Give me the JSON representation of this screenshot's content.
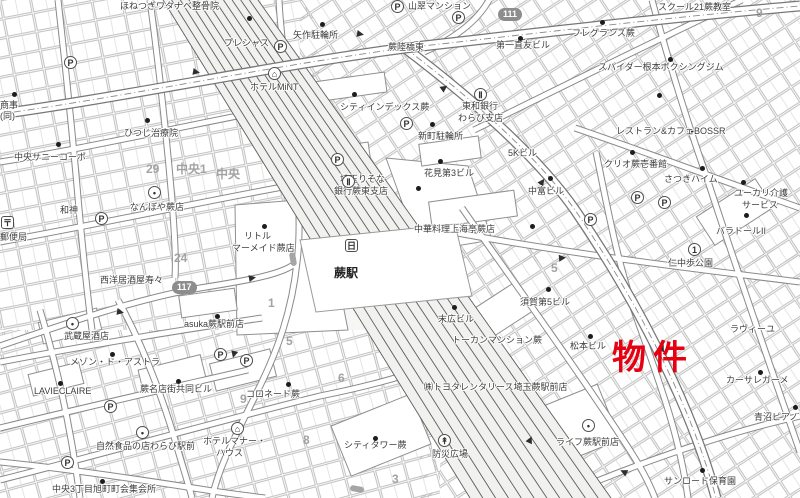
{
  "map": {
    "property_marker": {
      "text": "物件",
      "color": "#e60012"
    },
    "station": {
      "name": "蕨駅"
    },
    "route_badges": [
      {
        "name": "route-badge-111",
        "number": "111",
        "x": 498,
        "y": 8
      },
      {
        "name": "route-badge-117",
        "number": "117",
        "x": 172,
        "y": 281
      }
    ],
    "labels": [
      {
        "n": "label-honetsugi-watanabe-seikotsuin",
        "t": "ほねつぎワタナベ整骨院",
        "x": 120,
        "y": 1
      },
      {
        "n": "label-sansui-mansion",
        "t": "山翠マンション",
        "x": 408,
        "y": 1
      },
      {
        "n": "label-school21-warabi",
        "t": "スクール21蕨教室",
        "x": 658,
        "y": 2
      },
      {
        "n": "label-precious",
        "t": "プレシャス",
        "x": 224,
        "y": 38
      },
      {
        "n": "label-yahagi-bicycle-park",
        "t": "矢作駐輪所",
        "x": 293,
        "y": 30
      },
      {
        "n": "label-warabi-rikkyo-higashi",
        "t": "蕨陸橋東",
        "x": 388,
        "y": 42
      },
      {
        "n": "label-daiichi-naotomo-bldg",
        "t": "第一直友ビル",
        "x": 496,
        "y": 40
      },
      {
        "n": "label-fragrance-warabi",
        "t": "フレグランス蕨",
        "x": 572,
        "y": 28
      },
      {
        "n": "label-block-9",
        "t": "9",
        "x": 756,
        "y": 8,
        "c": "gray"
      },
      {
        "n": "label-hotel-mint",
        "t": "ホテルMiNT",
        "x": 250,
        "y": 82
      },
      {
        "n": "label-city-index-warabi",
        "t": "シティインデックス蕨",
        "x": 340,
        "y": 102
      },
      {
        "n": "label-shinmachi-bicycle-park",
        "t": "新町駐輪所",
        "x": 418,
        "y": 131
      },
      {
        "n": "label-towa-bank-1",
        "t": "東和銀行",
        "x": 462,
        "y": 101
      },
      {
        "n": "label-towa-bank-2",
        "t": "わらび支店",
        "x": 458,
        "y": 113
      },
      {
        "n": "label-spider-nemoto-boxing-gym",
        "t": "スパイダー根本ボクシングジム",
        "x": 598,
        "y": 62
      },
      {
        "n": "label-restaurant-cafe-bossr",
        "t": "レストラン&カフェBOSSR",
        "x": 616,
        "y": 126
      },
      {
        "n": "label-5k-bldg",
        "t": "5Kビル",
        "x": 508,
        "y": 148
      },
      {
        "n": "label-clio-warabi-ichibankan",
        "t": "クリオ蕨壱番館",
        "x": 604,
        "y": 159
      },
      {
        "n": "label-satsuki-heim",
        "t": "さつきハイム",
        "x": 664,
        "y": 174
      },
      {
        "n": "label-yukari-kaigo-1",
        "t": "ユーカリ介護",
        "x": 734,
        "y": 188
      },
      {
        "n": "label-yukari-kaigo-2",
        "t": "サービス",
        "x": 742,
        "y": 200
      },
      {
        "n": "label-hitsuji-chiryoin",
        "t": "ひつじ治療院",
        "x": 124,
        "y": 128
      },
      {
        "n": "label-chuo-sunny-corpo",
        "t": "中央サニーコーポ",
        "x": 14,
        "y": 152
      },
      {
        "n": "label-shoji",
        "t": "商事",
        "x": 0,
        "y": 100
      },
      {
        "n": "label-shoji-dou",
        "t": "(同)",
        "x": 0,
        "y": 111
      },
      {
        "n": "label-hanami-dai3-bldg",
        "t": "花見第3ビル",
        "x": 424,
        "y": 168
      },
      {
        "n": "label-nakatomi-bldg",
        "t": "中富ビル",
        "x": 528,
        "y": 186
      },
      {
        "n": "label-saitama-risona-1",
        "t": "埼玉りそな",
        "x": 340,
        "y": 174
      },
      {
        "n": "label-saitama-risona-2",
        "t": "銀行蕨東支店",
        "x": 334,
        "y": 186
      },
      {
        "n": "label-chuka-shanghai-tei",
        "t": "中華料理上海亭蕨店",
        "x": 414,
        "y": 224
      },
      {
        "n": "label-wajin",
        "t": "和神",
        "x": 60,
        "y": 205
      },
      {
        "n": "label-nanboya-warabi",
        "t": "なんぼや蕨店",
        "x": 130,
        "y": 202
      },
      {
        "n": "label-block-29",
        "t": "29",
        "x": 146,
        "y": 164,
        "c": "gray"
      },
      {
        "n": "label-block-chuo1",
        "t": "中央1",
        "x": 176,
        "y": 164,
        "c": "gray"
      },
      {
        "n": "label-block-chuo",
        "t": "中央",
        "x": 216,
        "y": 169,
        "c": "gray"
      },
      {
        "n": "label-block-24",
        "t": "24",
        "x": 174,
        "y": 253,
        "c": "gray"
      },
      {
        "n": "label-post-office",
        "t": "郵便局",
        "x": 0,
        "y": 232
      },
      {
        "n": "label-little-mermaid-1",
        "t": "リトル",
        "x": 244,
        "y": 231
      },
      {
        "n": "label-little-mermaid-2",
        "t": "マーメイド蕨店",
        "x": 232,
        "y": 243
      },
      {
        "n": "label-paradol-2",
        "t": "バラドールII",
        "x": 716,
        "y": 226
      },
      {
        "n": "label-nichu-aruki-park",
        "t": "仁中歩公園",
        "x": 668,
        "y": 258
      },
      {
        "n": "label-suehiro-bldg",
        "t": "末広ビル",
        "x": 438,
        "y": 314
      },
      {
        "n": "label-suga-dai5-bldg",
        "t": "須賀第5ビル",
        "x": 520,
        "y": 297
      },
      {
        "n": "label-seiyo-izakaya-suzu",
        "t": "西洋居酒屋寿々",
        "x": 100,
        "y": 275
      },
      {
        "n": "label-asuka-warabi-ekimae",
        "t": "asuka蕨駅前店",
        "x": 184,
        "y": 319
      },
      {
        "n": "label-musashiya-saketen",
        "t": "武蔵屋酒店",
        "x": 64,
        "y": 331
      },
      {
        "n": "label-maison-de-astra",
        "t": "メゾン・ド・アストラ",
        "x": 70,
        "y": 357
      },
      {
        "n": "label-lavieclaire",
        "t": "LAVIECLAIRE",
        "x": 34,
        "y": 386
      },
      {
        "n": "label-warabi-meitengai-bldg",
        "t": "蕨名店街共同ビル",
        "x": 140,
        "y": 384
      },
      {
        "n": "label-tokan-mansion-warabi",
        "t": "トーカンマンション蕨",
        "x": 452,
        "y": 335
      },
      {
        "n": "label-matsumoto-bldg",
        "t": "松本ビル",
        "x": 570,
        "y": 341
      },
      {
        "n": "label-lavieyu",
        "t": "ラヴィーユ",
        "x": 730,
        "y": 324
      },
      {
        "n": "label-casa-regame",
        "t": "カーサレガーメ",
        "x": 726,
        "y": 375
      },
      {
        "n": "label-aonuma-piano",
        "t": "青沼ピアノ",
        "x": 754,
        "y": 412
      },
      {
        "n": "label-block-1",
        "t": "1",
        "x": 268,
        "y": 298,
        "c": "gray"
      },
      {
        "n": "label-block-5a",
        "t": "5",
        "x": 286,
        "y": 336,
        "c": "gray"
      },
      {
        "n": "label-block-6",
        "t": "6",
        "x": 338,
        "y": 373,
        "c": "gray"
      },
      {
        "n": "label-block-5b",
        "t": "5",
        "x": 551,
        "y": 263,
        "c": "gray"
      },
      {
        "n": "label-block-3",
        "t": "3",
        "x": 392,
        "y": 474,
        "c": "gray"
      },
      {
        "n": "label-block-8",
        "t": "8",
        "x": 303,
        "y": 435,
        "c": "gray"
      },
      {
        "n": "label-block-9b",
        "t": "9",
        "x": 240,
        "y": 394,
        "c": "gray"
      },
      {
        "n": "label-colonnade-warabi",
        "t": "コロネード蕨",
        "x": 246,
        "y": 389
      },
      {
        "n": "label-shizenshokuhin-warabi",
        "t": "自然食品の店わらび駅前",
        "x": 96,
        "y": 441
      },
      {
        "n": "label-hotel-manor-1",
        "t": "ホテルマナー・",
        "x": 203,
        "y": 436
      },
      {
        "n": "label-hotel-manor-2",
        "t": "ハウス",
        "x": 216,
        "y": 448
      },
      {
        "n": "label-chuo3-shukaijo",
        "t": "中央3丁目旭町町会集会所",
        "x": 52,
        "y": 484
      },
      {
        "n": "label-city-tower-warabi",
        "t": "シティタワー蕨",
        "x": 344,
        "y": 440
      },
      {
        "n": "label-toyota-rentalease",
        "t": "㈱トヨタレンタリース埼玉蕨駅前店",
        "x": 424,
        "y": 382
      },
      {
        "n": "label-life-warabi-ekimae",
        "t": "ライフ蕨駅前店",
        "x": 556,
        "y": 437
      },
      {
        "n": "label-sunroad-hoikuen",
        "t": "サンロード保育園",
        "x": 664,
        "y": 476
      },
      {
        "n": "label-bosai-hiroba",
        "t": "防災広場",
        "x": 432,
        "y": 449
      },
      {
        "n": "label-warabi-station",
        "t": "蕨駅",
        "x": 334,
        "y": 268,
        "c": "station"
      }
    ],
    "icons": [
      {
        "name": "parking-icon",
        "glyph": "P",
        "x": 64,
        "y": 56
      },
      {
        "name": "parking-icon",
        "glyph": "P",
        "x": 274,
        "y": 40
      },
      {
        "name": "parking-icon",
        "glyph": "P",
        "x": 391,
        "y": 0
      },
      {
        "name": "parking-icon",
        "glyph": "P",
        "x": 452,
        "y": 11
      },
      {
        "name": "parking-icon",
        "glyph": "P",
        "x": 400,
        "y": 117
      },
      {
        "name": "parking-icon",
        "glyph": "P",
        "x": 95,
        "y": 212
      },
      {
        "name": "parking-icon",
        "glyph": "P",
        "x": 631,
        "y": 191
      },
      {
        "name": "parking-icon",
        "glyph": "P",
        "x": 658,
        "y": 196
      },
      {
        "name": "parking-icon",
        "glyph": "P",
        "x": 584,
        "y": 213
      },
      {
        "name": "parking-icon",
        "glyph": "P",
        "x": 104,
        "y": 400
      },
      {
        "name": "parking-icon",
        "glyph": "P",
        "x": 214,
        "y": 348
      },
      {
        "name": "parking-icon",
        "glyph": "P",
        "x": 61,
        "y": 456
      },
      {
        "name": "parking-icon",
        "glyph": "P",
        "x": 331,
        "y": 153
      },
      {
        "name": "parking-icon",
        "glyph": "P",
        "x": 240,
        "y": 354
      },
      {
        "name": "post-office-icon",
        "glyph": "〒",
        "x": 1,
        "y": 216,
        "shape": "box"
      },
      {
        "name": "bank-icon",
        "glyph": "Ⅱ",
        "x": 474,
        "y": 88
      },
      {
        "name": "bank-icon",
        "glyph": "Ⅱ",
        "x": 342,
        "y": 175
      },
      {
        "name": "park-number-icon",
        "glyph": "1",
        "x": 688,
        "y": 243
      },
      {
        "name": "hotel-icon",
        "glyph": "⌂",
        "x": 268,
        "y": 67
      },
      {
        "name": "hotel-icon",
        "glyph": "⌂",
        "x": 231,
        "y": 422
      },
      {
        "name": "shop-icon",
        "glyph": "•",
        "x": 148,
        "y": 186
      },
      {
        "name": "shop-icon",
        "glyph": "•",
        "x": 136,
        "y": 426
      },
      {
        "name": "shop-icon",
        "glyph": "•",
        "x": 582,
        "y": 419
      },
      {
        "name": "shop-icon",
        "glyph": "•",
        "x": 66,
        "y": 317
      },
      {
        "name": "plaza-icon",
        "glyph": "↟",
        "x": 438,
        "y": 434
      },
      {
        "name": "station-icon",
        "glyph": "日",
        "x": 345,
        "y": 239,
        "shape": "box"
      }
    ],
    "building_markers": [
      [
        247,
        16
      ],
      [
        320,
        22
      ],
      [
        352,
        92
      ],
      [
        430,
        122
      ],
      [
        438,
        159
      ],
      [
        668,
        57
      ],
      [
        630,
        150
      ],
      [
        700,
        166
      ],
      [
        741,
        180
      ],
      [
        548,
        176
      ],
      [
        744,
        213
      ],
      [
        145,
        118
      ],
      [
        56,
        142
      ],
      [
        12,
        92
      ],
      [
        530,
        224
      ],
      [
        546,
        287
      ],
      [
        452,
        305
      ],
      [
        110,
        352
      ],
      [
        58,
        381
      ],
      [
        176,
        379
      ],
      [
        588,
        334
      ],
      [
        758,
        370
      ],
      [
        793,
        405
      ],
      [
        286,
        382
      ],
      [
        373,
        436
      ],
      [
        700,
        468
      ],
      [
        100,
        479
      ],
      [
        215,
        314
      ],
      [
        262,
        224
      ],
      [
        600,
        20
      ],
      [
        518,
        36
      ],
      [
        657,
        93
      ],
      [
        416,
        186
      ]
    ]
  }
}
